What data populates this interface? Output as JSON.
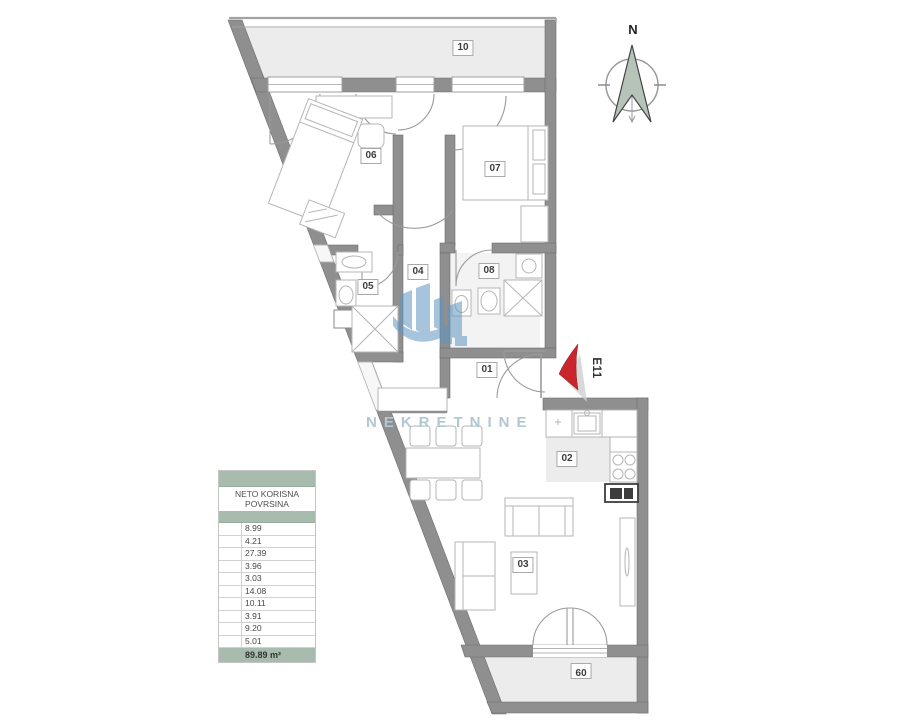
{
  "plan": {
    "compass_north_label": "N",
    "entrance_label": "E11",
    "watermark_text": "NEKRETNINE",
    "rooms": [
      "01",
      "02",
      "03",
      "04",
      "05",
      "06",
      "07",
      "08",
      "09",
      "10"
    ]
  },
  "area_table": {
    "header_line1": "NETO KORISNA",
    "header_line2": "POVRSINA",
    "rows": [
      "8.99",
      "4.21",
      "27.39",
      "3.96",
      "3.03",
      "14.08",
      "10.11",
      "3.91",
      "9.20",
      "5.01"
    ],
    "total": "89.89 m²"
  },
  "colors": {
    "wall_gray": "#8f8f8f",
    "floor_gray": "#ececec",
    "table_green": "#a7bcae",
    "watermark_blue": "#b1c7d3",
    "logo_blue": "#5f97c3",
    "entrance_red": "#c9252c"
  }
}
